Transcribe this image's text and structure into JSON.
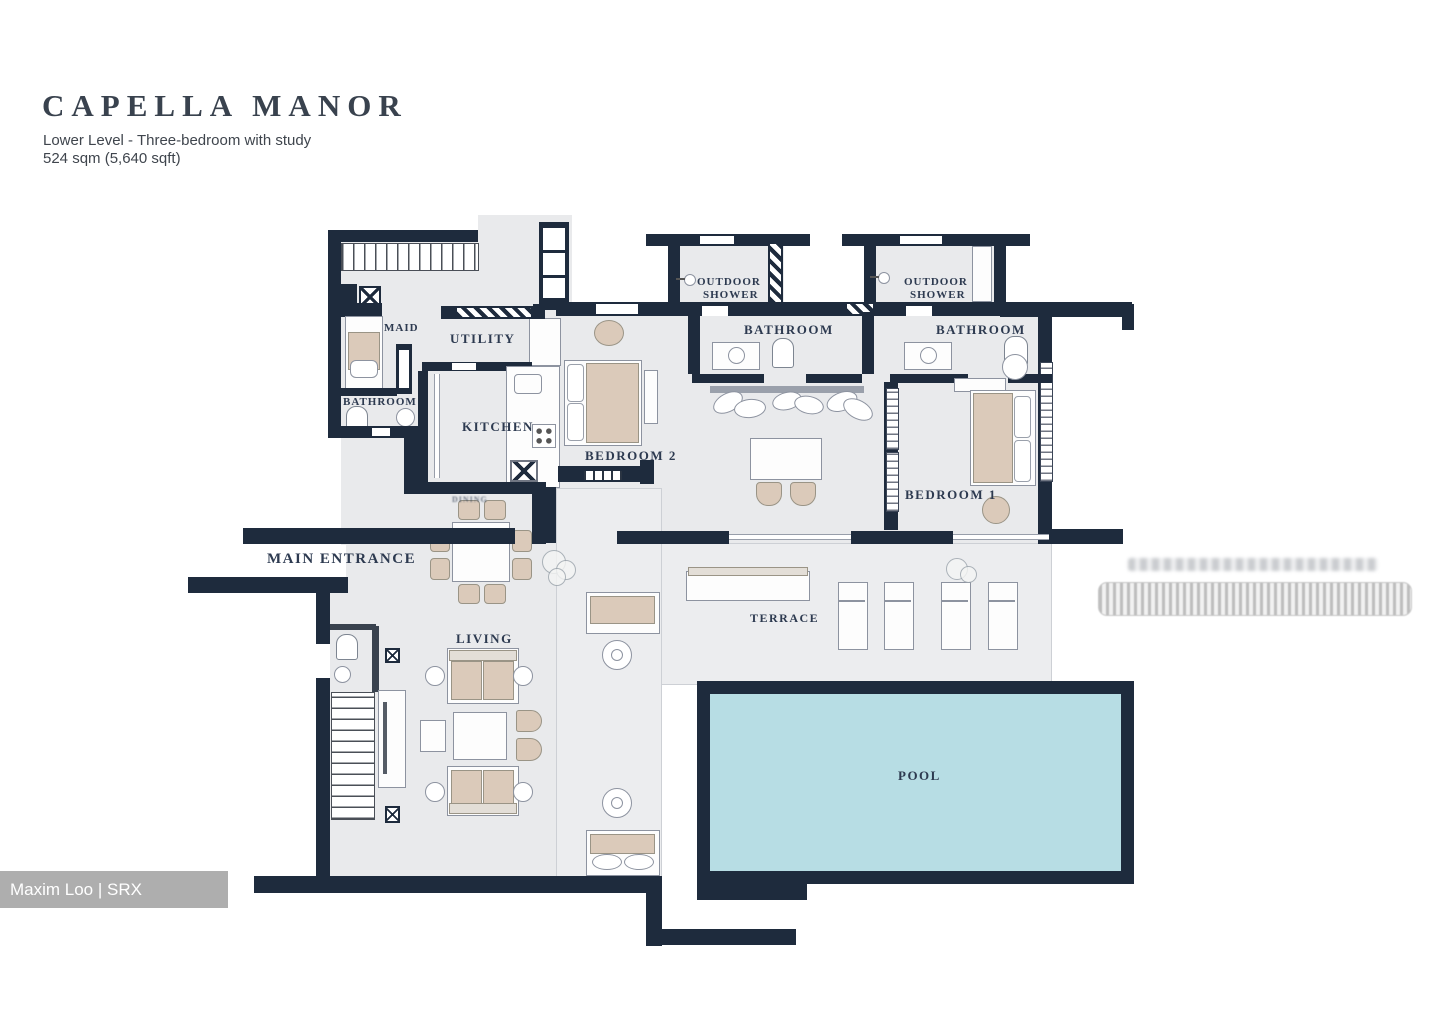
{
  "header": {
    "title": "CAPELLA MANOR",
    "subtitle": "Lower Level - Three-bedroom with study",
    "area": "524 sqm (5,640 sqft)"
  },
  "rooms": {
    "maid": "MAID",
    "utility": "UTILITY",
    "maid_bathroom": "BATHROOM",
    "kitchen": "KITCHEN",
    "dining": "DINING",
    "bedroom2": "BEDROOM 2",
    "outdoor_shower": {
      "line1": "OUTDOOR",
      "line2": "SHOWER"
    },
    "bathroom_left": "BATHROOM",
    "bathroom_right": "BATHROOM",
    "bedroom1": "BEDROOM 1",
    "main_entrance": "MAIN ENTRANCE",
    "living": "LIVING",
    "terrace": "TERRACE",
    "pool": "POOL"
  },
  "watermark": {
    "text": "Maxim Loo | SRX PROPERTY"
  },
  "colors": {
    "wall": "#1e2b3d",
    "floor": "#e9eaec",
    "pool_water": "#b7dde4",
    "furniture_beige": "#dbcaba",
    "label_text": "#2d3a50",
    "watermark_bg": "#aeaeae"
  }
}
